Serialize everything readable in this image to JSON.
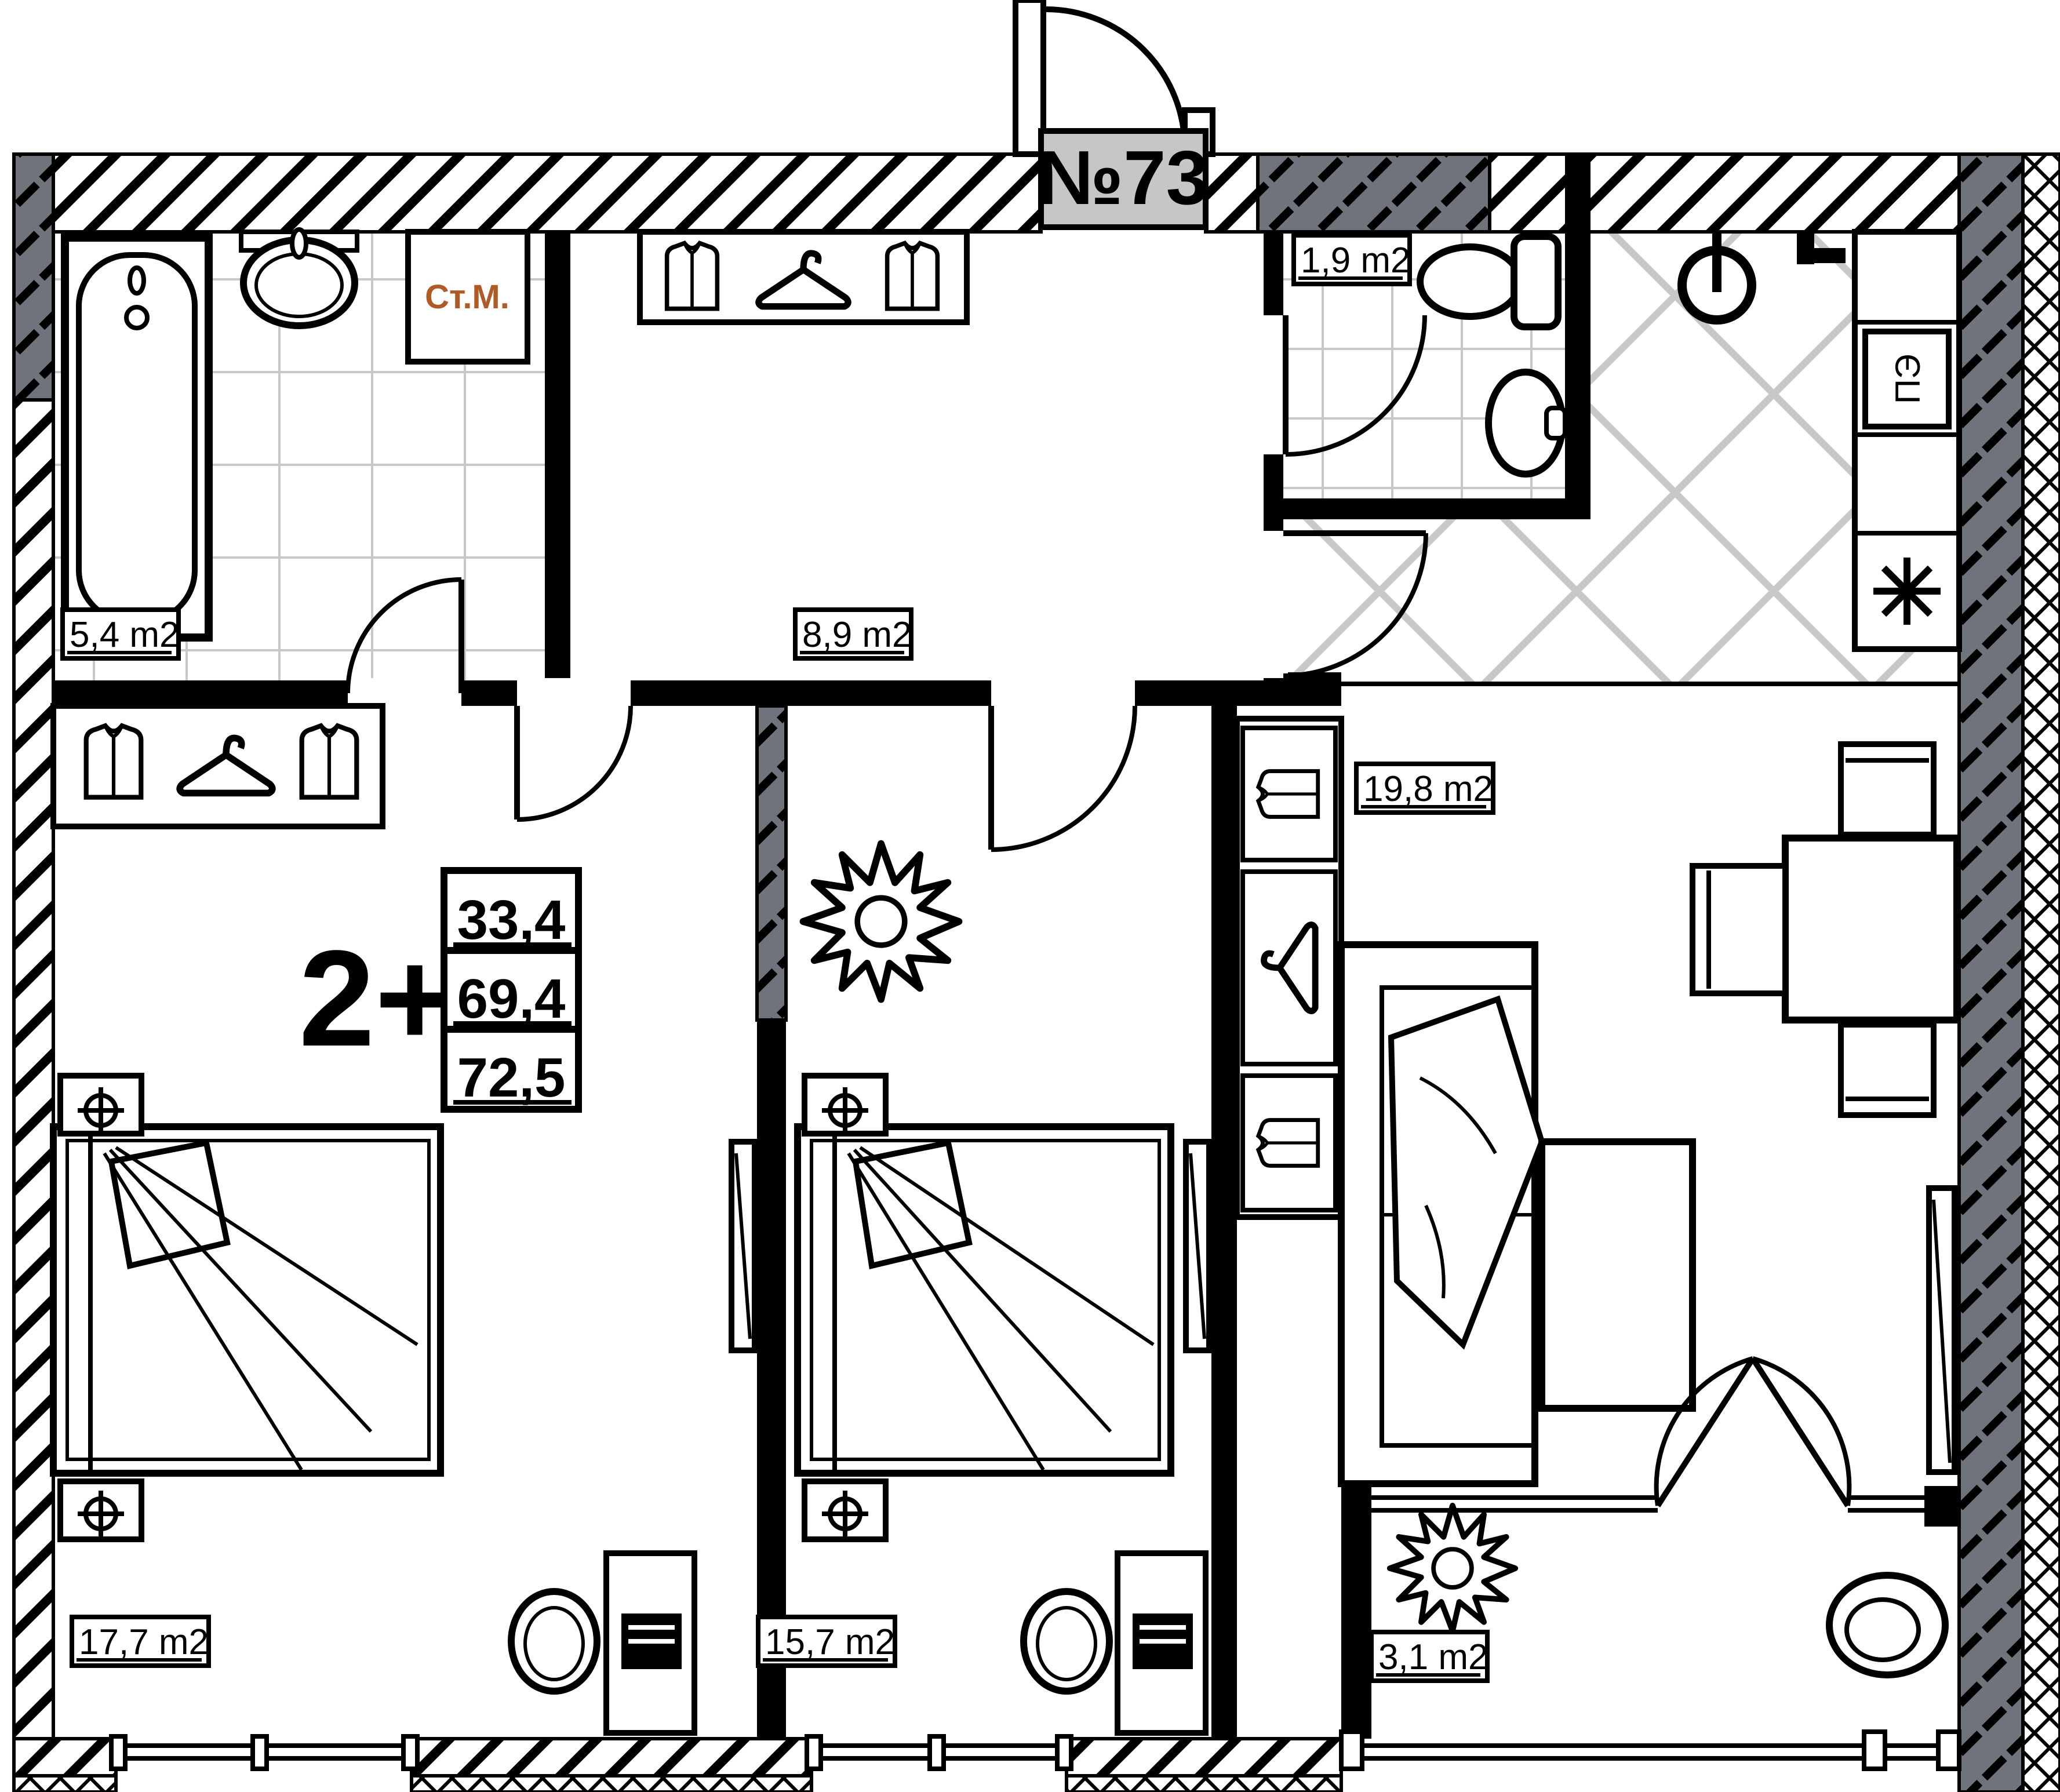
{
  "plan": {
    "apartment_number": "№73",
    "flat_type": "2+",
    "area_table": {
      "living": "33,4",
      "total": "69,4",
      "total_with_balcony": "72,5"
    },
    "rooms": {
      "bathroom": {
        "area": "5,4 m2"
      },
      "hallway": {
        "area": "8,9 m2"
      },
      "wc": {
        "area": "1,9 m2"
      },
      "living_room": {
        "area": "19,8 m2"
      },
      "bedroom_main": {
        "area": "17,7 m2"
      },
      "bedroom_second": {
        "area": "15,7 m2"
      },
      "balcony": {
        "area": "3,1 m2"
      }
    },
    "annotations": {
      "washing_machine": "Ст.М.",
      "electric_stove": "ПЭ"
    },
    "colors": {
      "walls": "#000000",
      "insulation_gray": "#6f747c",
      "plate_gray": "#c6c6c6",
      "washing_machine_text": "#b05a28",
      "tile_lines": "#c8c8c8"
    }
  }
}
